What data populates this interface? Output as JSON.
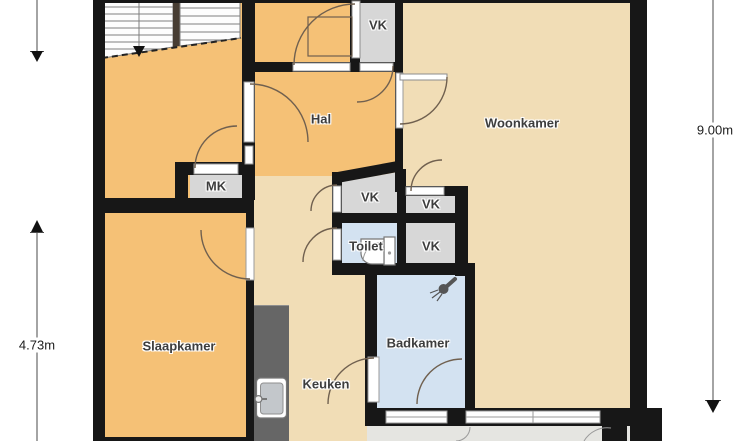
{
  "title": "Floor plan",
  "rooms": {
    "hal": {
      "label": "Hal"
    },
    "woonkamer": {
      "label": "Woonkamer"
    },
    "slaapkamer": {
      "label": "Slaapkamer"
    },
    "keuken": {
      "label": "Keuken"
    },
    "badkamer": {
      "label": "Badkamer"
    },
    "toilet": {
      "label": "Toilet"
    },
    "mk": {
      "label": "MK"
    },
    "vk_top": {
      "label": "VK"
    },
    "vk_nw": {
      "label": "VK"
    },
    "vk_ne": {
      "label": "VK"
    },
    "vk_se": {
      "label": "VK"
    }
  },
  "dimensions": {
    "right": {
      "label": "9.00m"
    },
    "left": {
      "label": "4.73m"
    }
  },
  "icons": {
    "stairs": "staircase-icon",
    "stairs_direction": "stair-direction-arrow-icon",
    "kitchen_sink": "kitchen-sink-icon",
    "toilet_fixture": "toilet-icon",
    "shower": "shower-head-icon",
    "dimension_arrow": "dimension-arrow-icon"
  },
  "colors": {
    "floor_orange": "#f5c176",
    "floor_beige": "#f1ddb6",
    "floor_gray": "#d7d7d7",
    "floor_blue": "#d3e2f1",
    "wall": "#171717",
    "counter": "#666666",
    "balcony": "#e5e5e1"
  }
}
